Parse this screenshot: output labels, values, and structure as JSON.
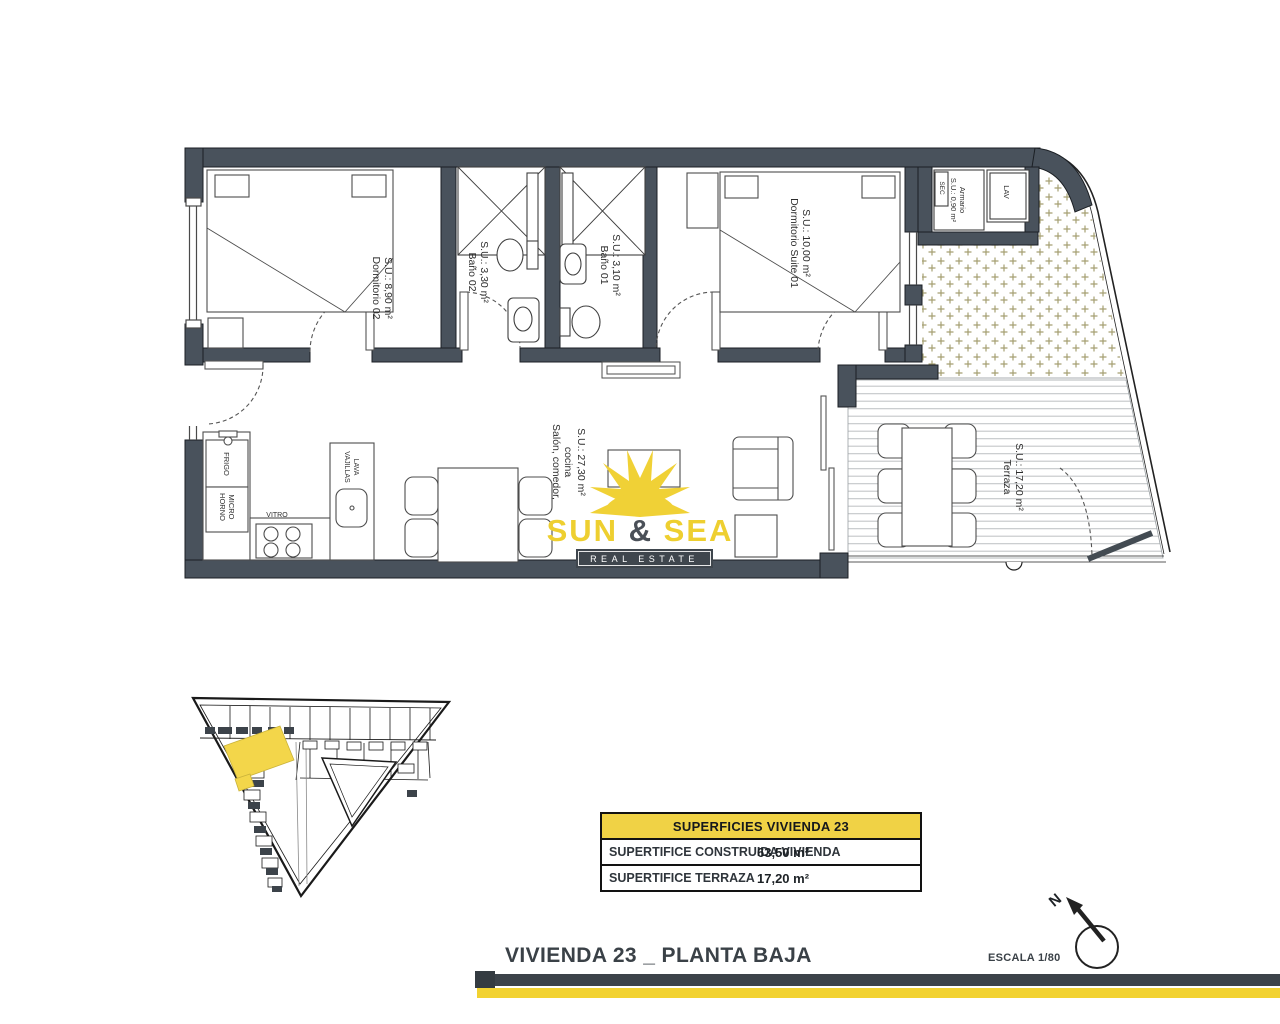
{
  "colors": {
    "wall": "#49525c",
    "accent_yellow": "#f0d136",
    "dark_bar": "#3c434a",
    "terrace_hatch": "#a59f72"
  },
  "plan": {
    "rooms": [
      {
        "name": "Dormitorio 02",
        "area": "S.U.: 8,90 m²"
      },
      {
        "name": "Baño 02",
        "area": "S.U.: 3,30 m²"
      },
      {
        "name": "Baño 01",
        "area": "S.U.: 3,10 m²"
      },
      {
        "name": "Dormitorio Suite 01",
        "area": "S.U.: 10,00 m²"
      },
      {
        "name": "Armario",
        "area": "S.U.: 0,90 m²"
      },
      {
        "name": "Salón, comedor,",
        "name_line2": "cocina",
        "area": "S.U.: 27,30 m²"
      },
      {
        "name": "Terraza",
        "area": "S.U.: 17,20 m²"
      }
    ],
    "appliances": {
      "fridge": "FRIGO",
      "oven": "HORNO",
      "micro": "MICRO",
      "hob": "VITRO",
      "dw1": "LAVA",
      "dw2": "VAJILLAS",
      "washer": "LAV",
      "dryer": "SEC"
    }
  },
  "logo": {
    "sun": "SUN",
    "amp": "&",
    "sea": "SEA",
    "tagline": "REAL ESTATE"
  },
  "summary_table": {
    "header": "SUPERFICIES VIVIENDA 23",
    "rows": [
      {
        "label": "SUPERTIFICE CONSTRUIDA VIVIENDA",
        "value": "63,50 m²"
      },
      {
        "label": "SUPERTIFICE TERRAZA",
        "value": "17,20 m²"
      }
    ]
  },
  "footer": {
    "title": "VIVIENDA 23 _ PLANTA BAJA",
    "scale": "ESCALA 1/80",
    "north_letter": "N"
  }
}
